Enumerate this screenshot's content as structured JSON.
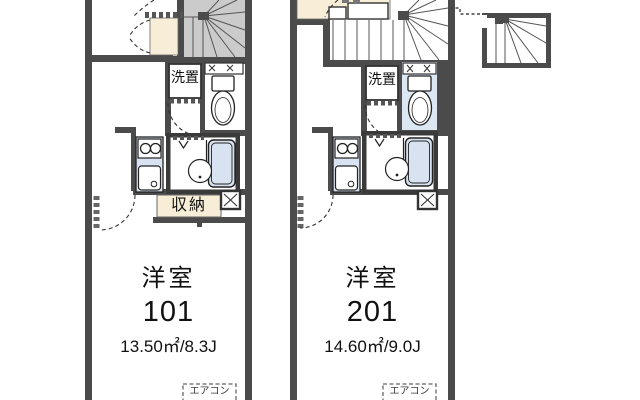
{
  "plan": {
    "units": [
      {
        "room_type": "洋室",
        "room_number": "101",
        "area": "13.50㎡/8.3J",
        "washer_label": "洗置",
        "closet_label": "収納",
        "aircon_label": "エアコン"
      },
      {
        "room_type": "洋室",
        "room_number": "201",
        "area": "14.60㎡/9.0J",
        "washer_label": "洗置",
        "aircon_label": "エアコン"
      }
    ]
  },
  "colors": {
    "bg": "#ffffff",
    "wall": "#4b4b4b",
    "wall-dark": "#3a3a3a",
    "stair-fill": "#cbcbcb",
    "cream": "#f8eed8",
    "fixture-blue": "#d8e2f0",
    "toilet-room-blue": "#dce7f4",
    "text": "#111111"
  }
}
